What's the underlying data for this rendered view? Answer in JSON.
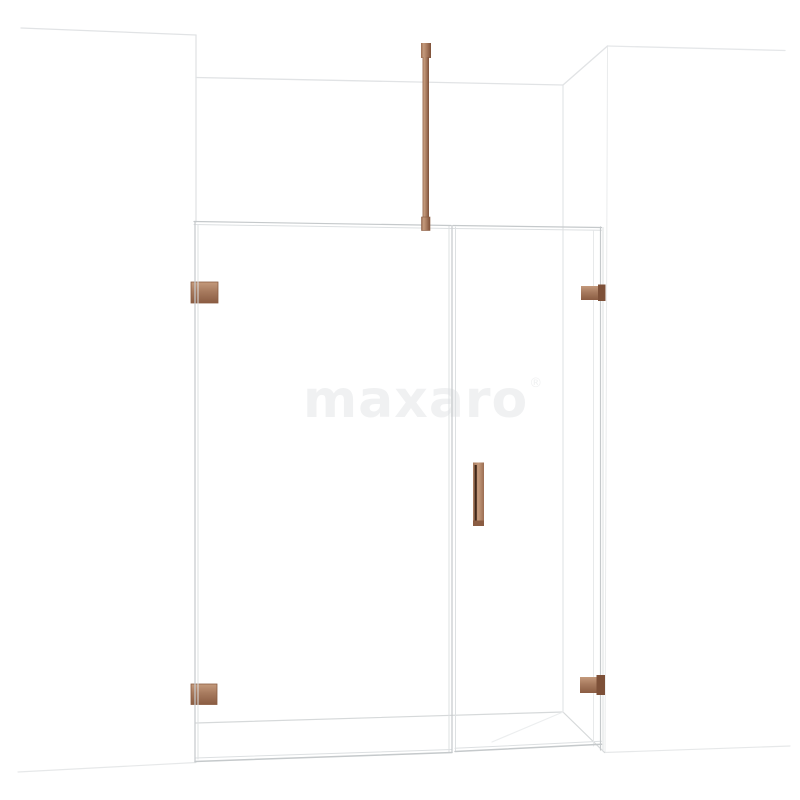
{
  "meta": {
    "description": "Product render: walk-in shower enclosure with fixed glass panel, hinged glass door and copper hardware in a white niche",
    "background": "#ffffff"
  },
  "watermark": {
    "text": "maxaro",
    "mark": "®",
    "color": "#f0f1f2"
  },
  "colors": {
    "copper": "#a77a5e",
    "copper_mid": "#9b6d52",
    "copper_dark": "#7d5038",
    "copper_deep": "#8a5c42",
    "copper_light": "#c49a7c",
    "handle_slot": "#301a0e",
    "glass_line": "#c5c9cb",
    "glass_line_light": "#dde0e2",
    "glass_line_faint": "#e7e9ea",
    "wall_line": "#e1e3e5",
    "floor_line": "#d6d9da",
    "shadow_line": "#eceeef"
  }
}
